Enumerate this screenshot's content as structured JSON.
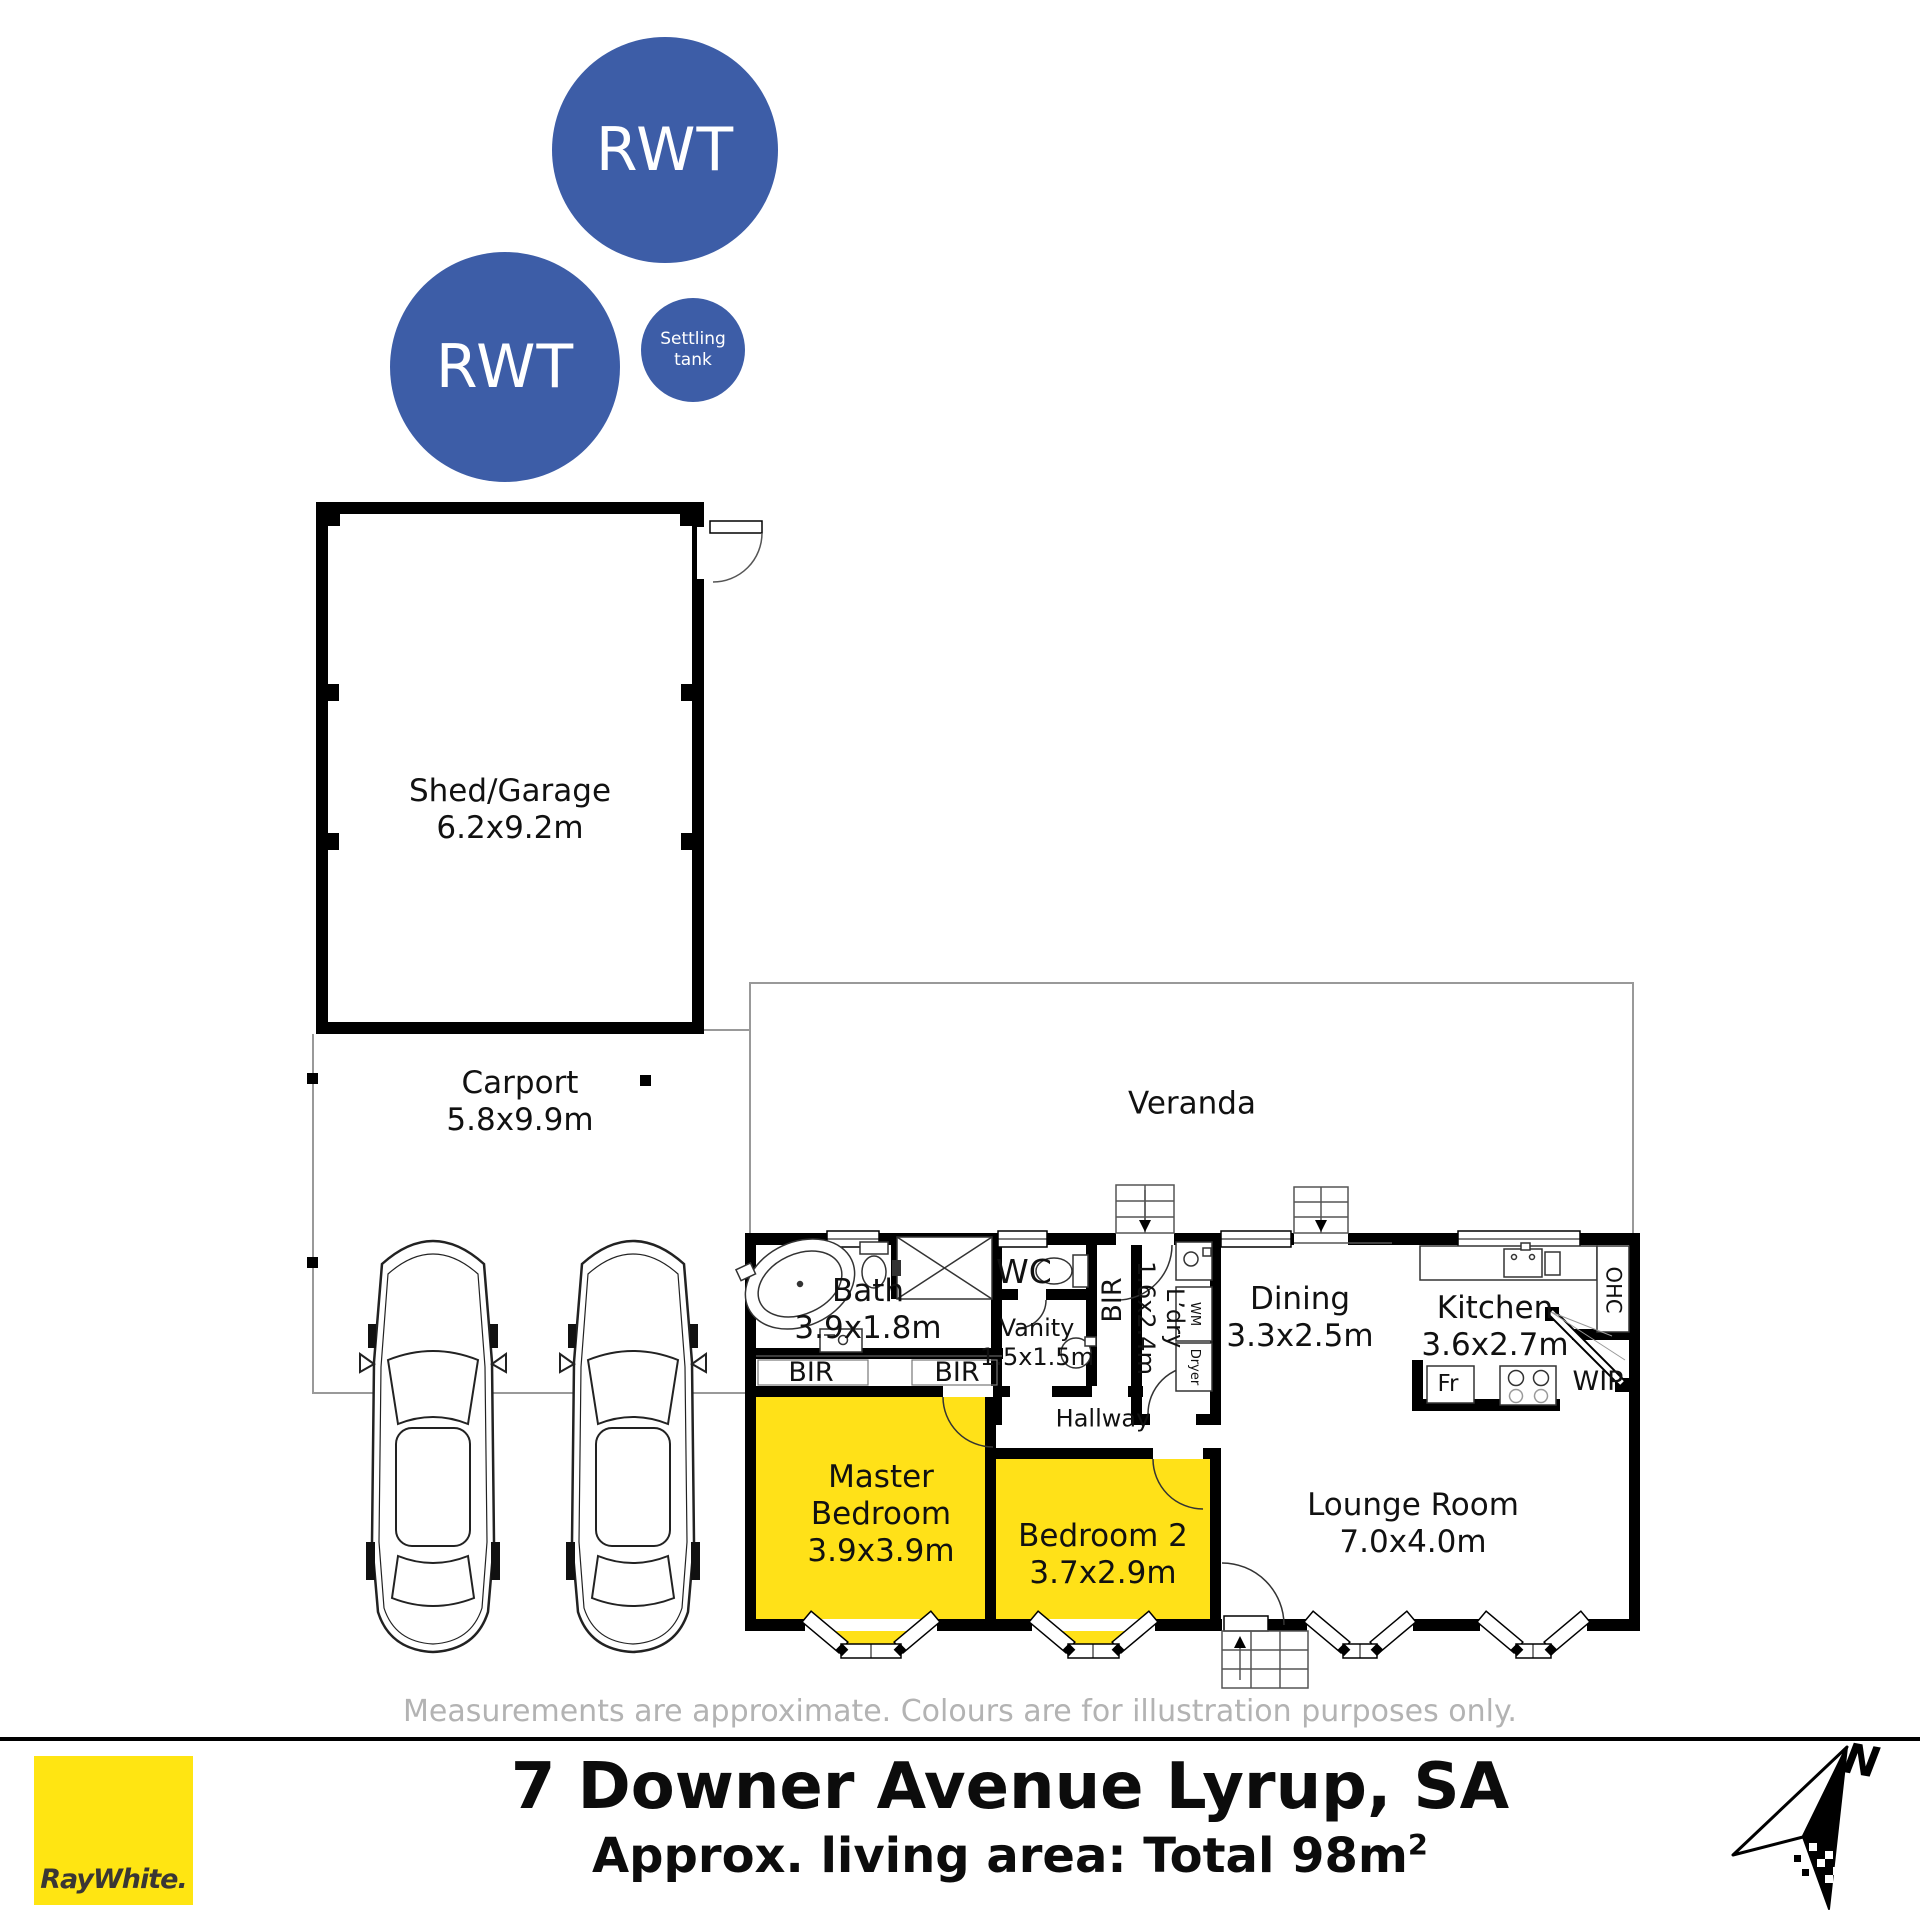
{
  "colors": {
    "tank_blue": "#3d5da7",
    "room_yellow": "#ffe118",
    "brand_yellow": "#ffe512",
    "wall_black": "#000000",
    "muted_gray": "#b3b3b3"
  },
  "tanks": {
    "rwt1": "RWT",
    "rwt2": "RWT",
    "settling": {
      "line1": "Settling",
      "line2": "tank"
    }
  },
  "outbuildings": {
    "shed": {
      "name": "Shed/Garage",
      "dims": "6.2x9.2m"
    },
    "carport": {
      "name": "Carport",
      "dims": "5.8x9.9m"
    },
    "veranda": {
      "name": "Veranda"
    }
  },
  "rooms": {
    "bath": {
      "name": "Bath",
      "dims": "3.9x1.8m"
    },
    "wc": {
      "name": "WC"
    },
    "vanity": {
      "name": "Vanity",
      "dims": "1.5x1.5m"
    },
    "ldry": {
      "name": "L’dry",
      "dims": "1.6x2.4m"
    },
    "dining": {
      "name": "Dining",
      "dims": "3.3x2.5m"
    },
    "kitchen": {
      "name": "Kitchen",
      "dims": "3.6x2.7m"
    },
    "master": {
      "name": "Master Bedroom",
      "dims": "3.9x3.9m"
    },
    "bed2": {
      "name": "Bedroom 2",
      "dims": "3.7x2.9m"
    },
    "lounge": {
      "name": "Lounge Room",
      "dims": "7.0x4.0m"
    }
  },
  "labels": {
    "hallway": "Hallway",
    "bir_a": "BIR",
    "bir_b": "BIR",
    "bir_c": "BIR",
    "wm": "WM",
    "dryer": "Dryer",
    "ohc": "OHC",
    "fr": "Fr",
    "wip": "WIP"
  },
  "footer": {
    "disclaimer": "Measurements are approximate. Colours are for illustration purposes only.",
    "brand": "RayWhite.",
    "address": "7 Downer Avenue Lyrup, SA",
    "area_prefix": "Approx. living area: Total 98m",
    "area_sup": "2",
    "north": "N"
  }
}
